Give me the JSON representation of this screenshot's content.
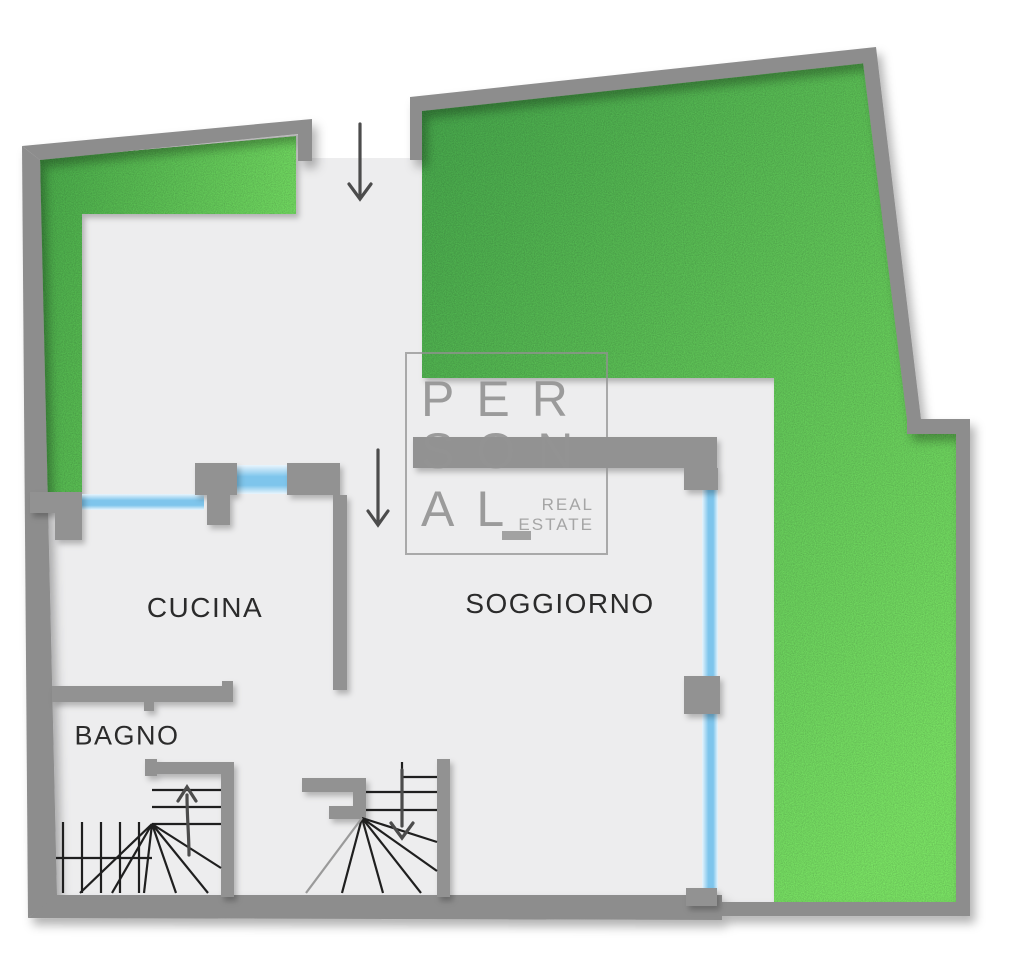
{
  "watermark": {
    "line1": "PER",
    "line2": "SON",
    "line3": "AL",
    "tagline_line1": "REAL",
    "tagline_line2": "ESTATE"
  },
  "rooms": {
    "kitchen": {
      "label": "CUCINA"
    },
    "living_room": {
      "label": "SOGGIORNO"
    },
    "bathroom": {
      "label": "BAGNO"
    }
  },
  "icons": {
    "entrance_arrow": {
      "name": "entrance-arrow-down",
      "direction": "down"
    },
    "entry_door_arrow": {
      "name": "entry-door-arrow-down",
      "direction": "down"
    },
    "stairs_up_arrow": {
      "name": "stairs-up-arrow",
      "direction": "up"
    },
    "stairs_down_arrow": {
      "name": "stairs-down-arrow",
      "direction": "down"
    }
  },
  "colors": {
    "grass_dark": "#46a94e",
    "grass_light": "#7ce869",
    "grass_dark2": "#4aae4d",
    "grass_light2": "#74df66",
    "wall_gray": "#8d8d8d",
    "window_blue": "#7ec5ec",
    "window_pale": "#e9f5fd",
    "floor_gray": "#ededee",
    "label_text": "#2b2b2b",
    "logo_gray": "#949494",
    "arrow_gray": "#4c4c4c"
  }
}
